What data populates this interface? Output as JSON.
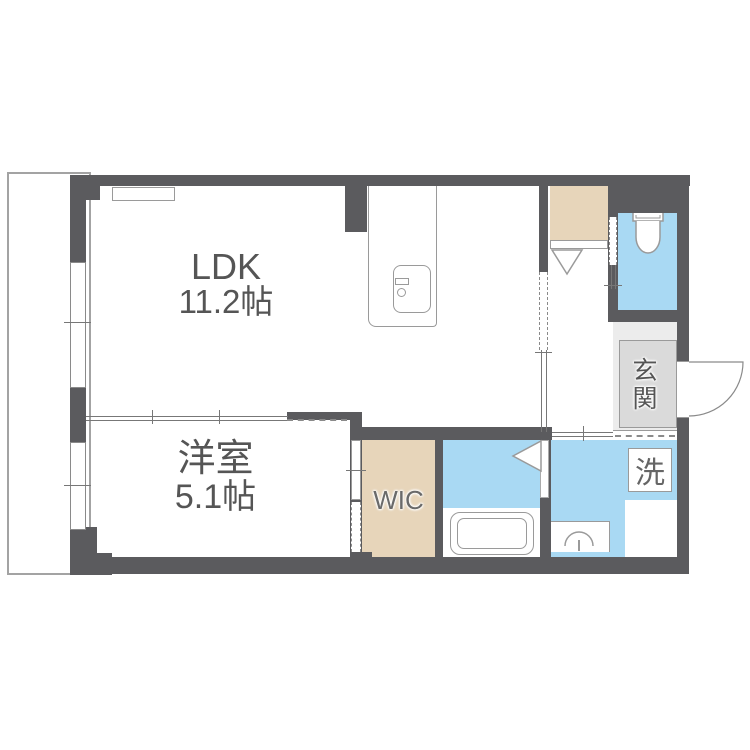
{
  "plan": {
    "type": "apartment-floor-plan",
    "rooms": {
      "ldk": {
        "name": "LDK",
        "size": "11.2帖"
      },
      "western": {
        "name": "洋室",
        "size": "5.1帖"
      },
      "wic": {
        "label": "WIC"
      },
      "entrance": {
        "label": "玄関"
      },
      "laundry": {
        "label": "洗"
      }
    }
  },
  "colors": {
    "wall": "#5b5b5e",
    "water": "#a9d9f3",
    "beige": "#e7d5ba",
    "entrance-outer": "#ececec",
    "entrance-inner": "#dadada",
    "line": "#777777",
    "edge": "#9a9a9a",
    "text": "#555555"
  }
}
